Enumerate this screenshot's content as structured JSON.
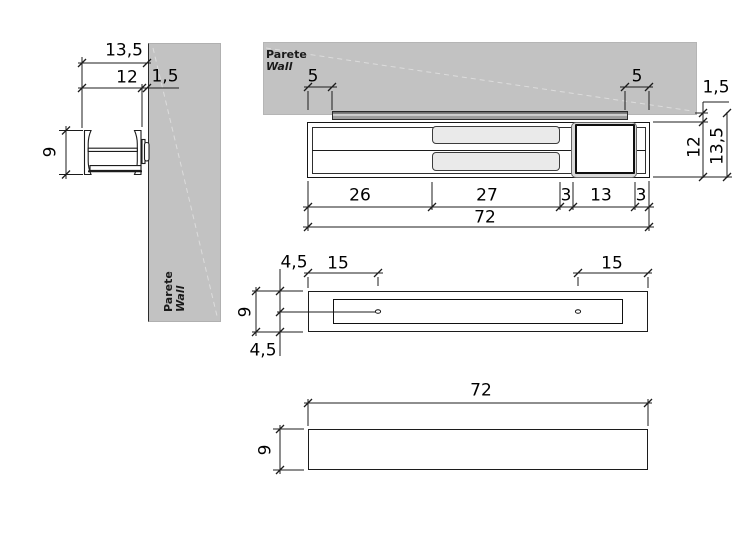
{
  "title": "Wall-mounted profile technical drawing",
  "wall": {
    "label_it": "Parete",
    "label_en": "Wall"
  },
  "dims": {
    "side": {
      "total_depth": "13,5",
      "body_depth": "12",
      "rail_depth": "1,5",
      "height": "9"
    },
    "top": {
      "rail_inset_left": "5",
      "rail_inset_right": "5",
      "rail_depth": "1,5",
      "body_depth": "12",
      "total_depth": "13,5",
      "segment_left": "26",
      "segment_center": "27",
      "gap_left": "3",
      "box_width": "13",
      "gap_right": "3",
      "total_length": "72"
    },
    "plan": {
      "offset_top": "4,5",
      "hole_offset_left": "15",
      "hole_offset_right": "15",
      "height": "9",
      "offset_bottom": "4,5"
    },
    "front": {
      "length": "72",
      "height": "9"
    }
  },
  "colors": {
    "wall": "#c2c2c2",
    "rail_light": "#cfcfcf",
    "rail_dark": "#6f6f6f",
    "panel": "#eaeaea",
    "line": "#1c1c1c"
  }
}
